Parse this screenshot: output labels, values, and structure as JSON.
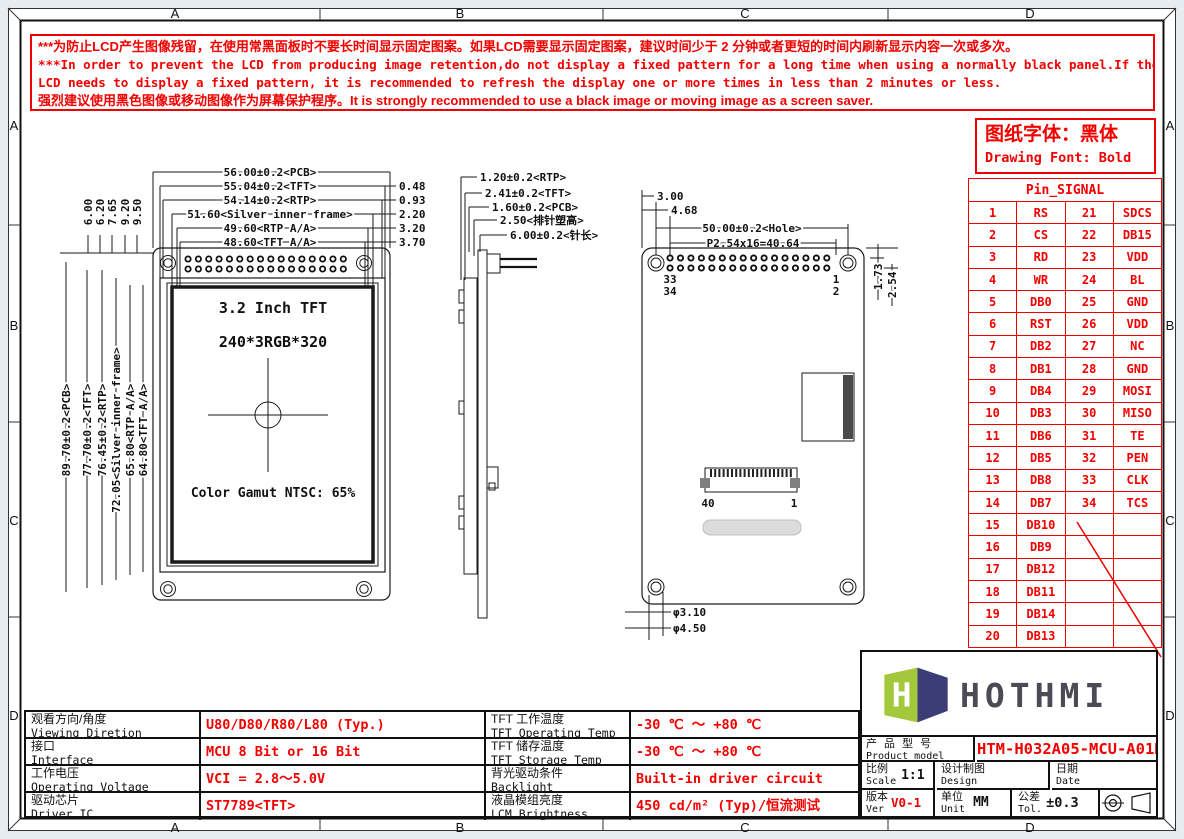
{
  "frame": {
    "zones": [
      "A",
      "B",
      "C",
      "D"
    ]
  },
  "warning": {
    "line1": "***为防止LCD产生图像残留，在使用常黑面板时不要长时间显示固定图案。如果LCD需要显示固定图案，建议时间少于 2 分钟或者更短的时间内刷新显示内容一次或多次。",
    "line2": "***In order to prevent the LCD from producing image retention,do not display a fixed pattern for a long time when using a normally black panel.If the",
    "line3": " LCD needs to display a fixed pattern,  it is recommended to refresh the display one or more times in less than 2 minutes or less.",
    "line4": "强烈建议使用黑色图像或移动图像作为屏幕保护程序。It is strongly recommended to use a black image or moving image as a screen saver."
  },
  "font_note": {
    "cn": "图纸字体：黑体",
    "en": "Drawing Font: Bold"
  },
  "pin_table": {
    "title": "Pin_SIGNAL",
    "rows": [
      {
        "p1": "1",
        "s1": "RS",
        "p2": "21",
        "s2": "SDCS"
      },
      {
        "p1": "2",
        "s1": "CS",
        "p2": "22",
        "s2": "DB15"
      },
      {
        "p1": "3",
        "s1": "RD",
        "p2": "23",
        "s2": "VDD"
      },
      {
        "p1": "4",
        "s1": "WR",
        "p2": "24",
        "s2": "BL"
      },
      {
        "p1": "5",
        "s1": "DB0",
        "p2": "25",
        "s2": "GND"
      },
      {
        "p1": "6",
        "s1": "RST",
        "p2": "26",
        "s2": "VDD"
      },
      {
        "p1": "7",
        "s1": "DB2",
        "p2": "27",
        "s2": "NC"
      },
      {
        "p1": "8",
        "s1": "DB1",
        "p2": "28",
        "s2": "GND"
      },
      {
        "p1": "9",
        "s1": "DB4",
        "p2": "29",
        "s2": "MOSI"
      },
      {
        "p1": "10",
        "s1": "DB3",
        "p2": "30",
        "s2": "MISO"
      },
      {
        "p1": "11",
        "s1": "DB6",
        "p2": "31",
        "s2": "TE"
      },
      {
        "p1": "12",
        "s1": "DB5",
        "p2": "32",
        "s2": "PEN"
      },
      {
        "p1": "13",
        "s1": "DB8",
        "p2": "33",
        "s2": "CLK"
      },
      {
        "p1": "14",
        "s1": "DB7",
        "p2": "34",
        "s2": "TCS"
      },
      {
        "p1": "15",
        "s1": "DB10",
        "p2": "",
        "s2": ""
      },
      {
        "p1": "16",
        "s1": "DB9",
        "p2": "",
        "s2": ""
      },
      {
        "p1": "17",
        "s1": "DB12",
        "p2": "",
        "s2": ""
      },
      {
        "p1": "18",
        "s1": "DB11",
        "p2": "",
        "s2": ""
      },
      {
        "p1": "19",
        "s1": "DB14",
        "p2": "",
        "s2": ""
      },
      {
        "p1": "20",
        "s1": "DB13",
        "p2": "",
        "s2": ""
      }
    ]
  },
  "front_view": {
    "top_dims": [
      "56.00±0.2<PCB>",
      "55.04±0.2<TFT>",
      "54.14±0.2<RTP>",
      "51.60<Silver inner frame>",
      "49.60<RTP A/A>",
      "48.60<TFT A/A>"
    ],
    "right_offsets": [
      "0.48",
      "0.93",
      "2.20",
      "3.20",
      "3.70"
    ],
    "left_dims": [
      "89.70±0.2<PCB>",
      "77.70±0.2<TFT>",
      "76.45±0.2<RTP>",
      "72.05<Silver inner frame>",
      "65.80<RTP A/A>",
      "64.80<TFT A/A>"
    ],
    "topleft_dims": [
      "6.00",
      "6.20",
      "7.65",
      "9.20",
      "9.50"
    ],
    "display": {
      "line1": "3.2 Inch TFT",
      "line2": "240*3RGB*320",
      "gamut": "Color Gamut NTSC: 65%"
    }
  },
  "side_view": {
    "dims": [
      "1.20±0.2<RTP>",
      "2.41±0.2<TFT>",
      "1.60±0.2<PCB>",
      "2.50<排针塑高>",
      "6.00±0.2<针长>"
    ]
  },
  "back_view": {
    "dims": {
      "d1": "3.00",
      "d2": "4.68",
      "hole": "50.00±0.2<Hole>",
      "pitch": "P2.54x16=40.64",
      "v1": "1.73",
      "v2": "2.54",
      "hole_d1": "φ3.10",
      "hole_d2": "φ4.50"
    },
    "pin_labels": {
      "tl": "33",
      "bl": "34",
      "tr": "1",
      "br": "2"
    },
    "conn_labels": {
      "left": "40",
      "right": "1"
    }
  },
  "spec_table": {
    "rows": [
      {
        "label_cn": "观看方向/角度",
        "label_en": "Viewing Diretion",
        "value": "U80/D80/R80/L80 (Typ.)",
        "label2_cn": "TFT 工作温度",
        "label2_en": "TFT Operating Temp",
        "value2": "-30 ℃ ～ +80 ℃"
      },
      {
        "label_cn": "接口",
        "label_en": "Interface",
        "value": "MCU 8 Bit or 16 Bit",
        "label2_cn": "TFT 储存温度",
        "label2_en": "TFT Storage Temp",
        "value2": "-30 ℃ ～ +80 ℃"
      },
      {
        "label_cn": "工作电压",
        "label_en": "Operating Voltage",
        "value": "VCI = 2.8～5.0V",
        "label2_cn": "背光驱动条件",
        "label2_en": "Backlight conditions",
        "value2": "Built-in driver circuit"
      },
      {
        "label_cn": "驱动芯片",
        "label_en": "Driver IC",
        "value": "ST7789<TFT>",
        "label2_cn": "液晶模组亮度",
        "label2_en": "LCM Brightness",
        "value2": "450 cd/m² (Typ)/恒流测试"
      }
    ]
  },
  "title_block": {
    "brand": "HOTHMI",
    "product_label_cn": "产 品 型 号",
    "product_label_en": "Product model",
    "product_model": "HTM-H032A05-MCU-A01R",
    "scale_cn": "比例",
    "scale_en": "Scale",
    "scale_value": "1:1",
    "design_cn": "设计制图",
    "design_en": "Design",
    "date_cn": "日期",
    "date_en": "Date",
    "date_value": "2025-09-22",
    "ver_cn": "版本",
    "ver_en": "Ver",
    "ver_value": "V0-1",
    "unit_cn": "单位",
    "unit_en": "Unit",
    "unit_value": "MM",
    "tol_cn": "公差",
    "tol_en": "Tol.",
    "tol_value": "±0.3"
  }
}
